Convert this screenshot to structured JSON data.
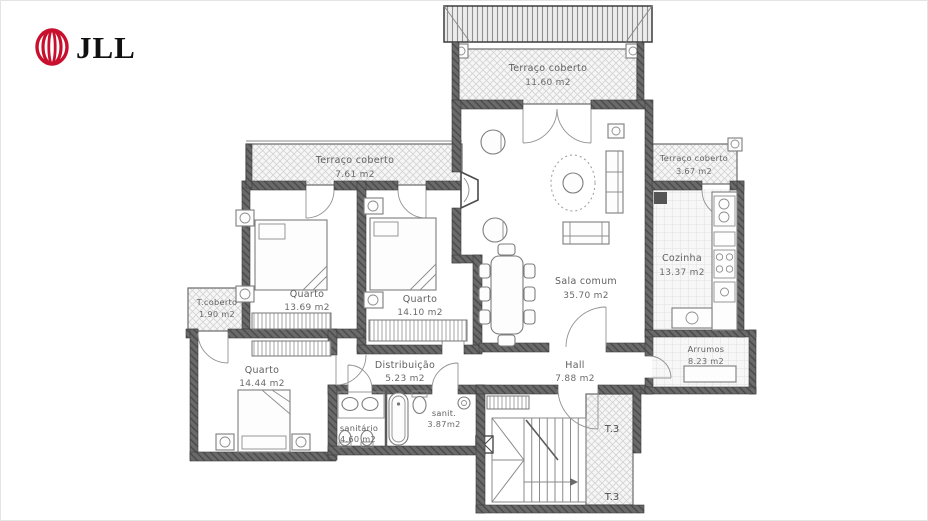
{
  "logo": {
    "brand": "JLL",
    "color": "#C8102E",
    "text_color": "#111111"
  },
  "plan": {
    "unit_label": "T.3",
    "rooms": [
      {
        "id": "terraco-coberto-top",
        "name": "Terraço coberto",
        "area": "11.60 m2"
      },
      {
        "id": "terraco-coberto-left",
        "name": "Terraço coberto",
        "area": "7.61 m2"
      },
      {
        "id": "terraco-coberto-right",
        "name": "Terraço coberto",
        "area": "3.67 m2"
      },
      {
        "id": "quarto-1",
        "name": "Quarto",
        "area": "13.69 m2"
      },
      {
        "id": "quarto-2",
        "name": "Quarto",
        "area": "14.10 m2"
      },
      {
        "id": "sala-comum",
        "name": "Sala comum",
        "area": "35.70 m2"
      },
      {
        "id": "cozinha",
        "name": "Cozinha",
        "area": "13.37 m2"
      },
      {
        "id": "t-coberto",
        "name": "T.coberto",
        "area": "1.90 m2"
      },
      {
        "id": "quarto-3",
        "name": "Quarto",
        "area": "14.44 m2"
      },
      {
        "id": "distribuicao",
        "name": "Distribuição",
        "area": "5.23 m2"
      },
      {
        "id": "hall",
        "name": "Hall",
        "area": "7.88 m2"
      },
      {
        "id": "arrumos",
        "name": "Arrumos",
        "area": "8.23 m2"
      },
      {
        "id": "sanitario",
        "name": "sanitário",
        "area": "4.60 m2"
      },
      {
        "id": "sanit",
        "name": "sanit.",
        "area": "3.87m2"
      }
    ]
  }
}
